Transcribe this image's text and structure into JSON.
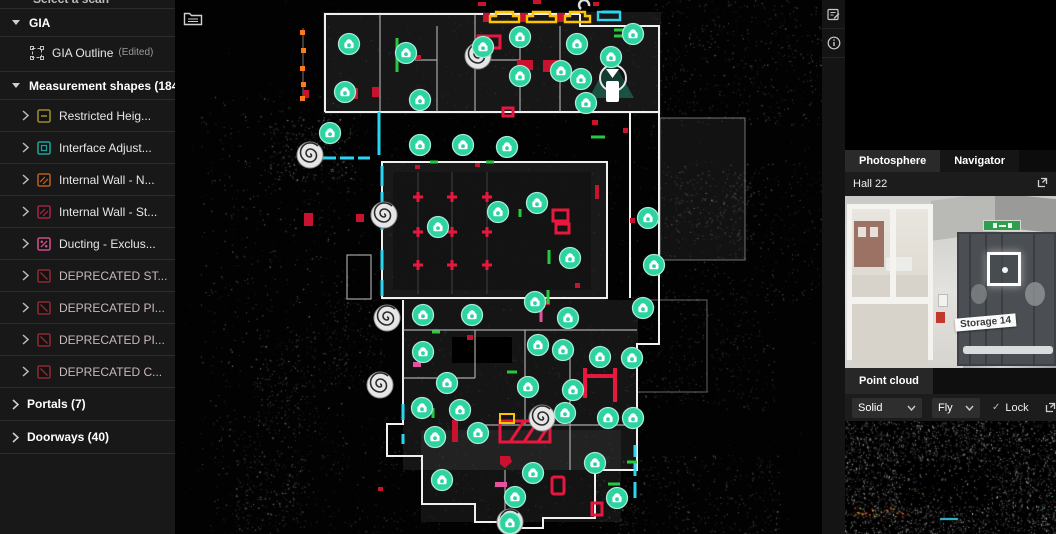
{
  "icons": {
    "check": "✓"
  },
  "sidebar": {
    "partial_top_label": "Select a scan",
    "gia_header": "GIA",
    "gia_outline": {
      "label": "GIA Outline",
      "suffix": "(Edited)"
    },
    "measurement_header": "Measurement shapes (184)",
    "shape_items": [
      {
        "label": "Restricted Heig...",
        "color": "#9c8a28",
        "glyph": "dash",
        "deprecated": false
      },
      {
        "label": "Interface Adjust...",
        "color": "#17a398",
        "glyph": "square",
        "deprecated": false
      },
      {
        "label": "Internal Wall - N...",
        "color": "#b35c1e",
        "glyph": "hatch",
        "deprecated": false
      },
      {
        "label": "Internal Wall - St...",
        "color": "#9e2643",
        "glyph": "hatch",
        "deprecated": false
      },
      {
        "label": "Ducting - Exclus...",
        "color": "#cc4e88",
        "glyph": "percent",
        "deprecated": false
      },
      {
        "label": "DEPRECATED ST...",
        "color": "#8a2a33",
        "glyph": "slash",
        "deprecated": true
      },
      {
        "label": "DEPRECATED PI...",
        "color": "#8a2a33",
        "glyph": "slash",
        "deprecated": true
      },
      {
        "label": "DEPRECATED PI...",
        "color": "#8a2a33",
        "glyph": "slash",
        "deprecated": true
      },
      {
        "label": "DEPRECATED C...",
        "color": "#8a2a33",
        "glyph": "slash",
        "deprecated": true
      }
    ],
    "portals_header": "Portals (7)",
    "doorways_header": "Doorways (40)"
  },
  "right_panel": {
    "tabs": [
      {
        "label": "Photosphere",
        "active": true
      },
      {
        "label": "Navigator",
        "active": false
      }
    ],
    "location_label": "Hall 22",
    "photo": {
      "sign_text": "Storage 14"
    },
    "point_cloud_header": "Point cloud",
    "controls": {
      "render_mode": "Solid",
      "nav_mode": "Fly",
      "lock_label": "Lock",
      "lock_checked": true
    }
  },
  "canvas": {
    "marker_color": "#2ed3a2",
    "selected_marker": [
      436,
      57
    ],
    "markers": [
      [
        174,
        44
      ],
      [
        231,
        53
      ],
      [
        308,
        47
      ],
      [
        345,
        37
      ],
      [
        402,
        44
      ],
      [
        458,
        34
      ],
      [
        170,
        92
      ],
      [
        245,
        100
      ],
      [
        345,
        76
      ],
      [
        386,
        71
      ],
      [
        406,
        79
      ],
      [
        411,
        103
      ],
      [
        155,
        133
      ],
      [
        245,
        145
      ],
      [
        288,
        145
      ],
      [
        332,
        147
      ],
      [
        323,
        212
      ],
      [
        263,
        227
      ],
      [
        362,
        203
      ],
      [
        395,
        258
      ],
      [
        360,
        302
      ],
      [
        248,
        315
      ],
      [
        297,
        315
      ],
      [
        393,
        318
      ],
      [
        473,
        218
      ],
      [
        479,
        265
      ],
      [
        468,
        308
      ],
      [
        248,
        352
      ],
      [
        272,
        383
      ],
      [
        247,
        408
      ],
      [
        285,
        410
      ],
      [
        260,
        437
      ],
      [
        303,
        433
      ],
      [
        353,
        387
      ],
      [
        363,
        345
      ],
      [
        388,
        350
      ],
      [
        425,
        357
      ],
      [
        457,
        358
      ],
      [
        398,
        390
      ],
      [
        390,
        413
      ],
      [
        433,
        418
      ],
      [
        458,
        418
      ],
      [
        420,
        463
      ],
      [
        358,
        473
      ],
      [
        340,
        497
      ],
      [
        267,
        480
      ],
      [
        442,
        498
      ],
      [
        335,
        523
      ]
    ],
    "survey_targets": [
      [
        135,
        155
      ],
      [
        209,
        215
      ],
      [
        212,
        318
      ],
      [
        205,
        385
      ],
      [
        367,
        418
      ],
      [
        335,
        522
      ],
      [
        303,
        56
      ]
    ]
  }
}
